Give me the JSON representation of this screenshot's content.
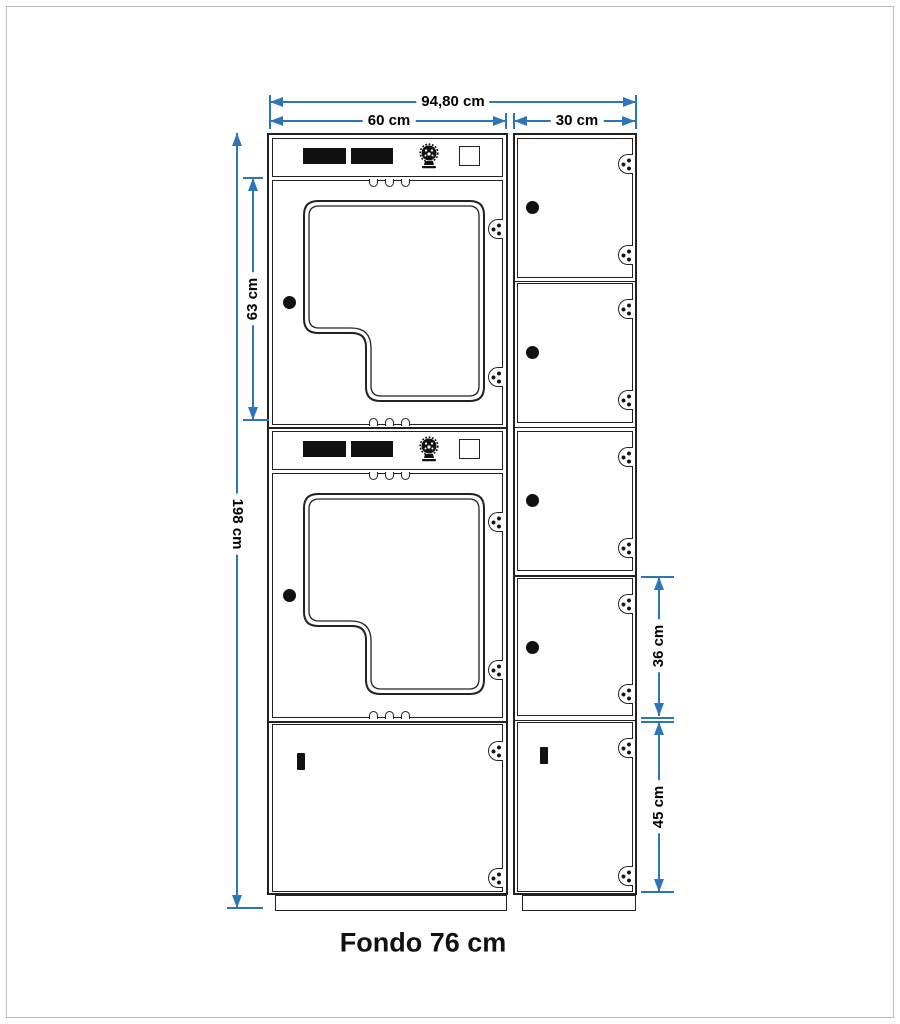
{
  "dimensions": {
    "total_width": "94,80 cm",
    "washer_width": "60 cm",
    "locker_width": "30 cm",
    "washer_door_height": "63 cm",
    "total_height": "198 cm",
    "locker_height": "36 cm",
    "bottom_locker_height": "45 cm"
  },
  "caption": {
    "depth": "Fondo 76 cm"
  },
  "colors": {
    "dimension_blue": "#2E75B6",
    "line_dark": "#222222",
    "frame_gray": "#bdbdbd"
  },
  "icons": [
    "coin-logo-icon",
    "hinge-icon",
    "lock-dot-icon",
    "key-slot-icon",
    "vent-notch",
    "start-button"
  ]
}
